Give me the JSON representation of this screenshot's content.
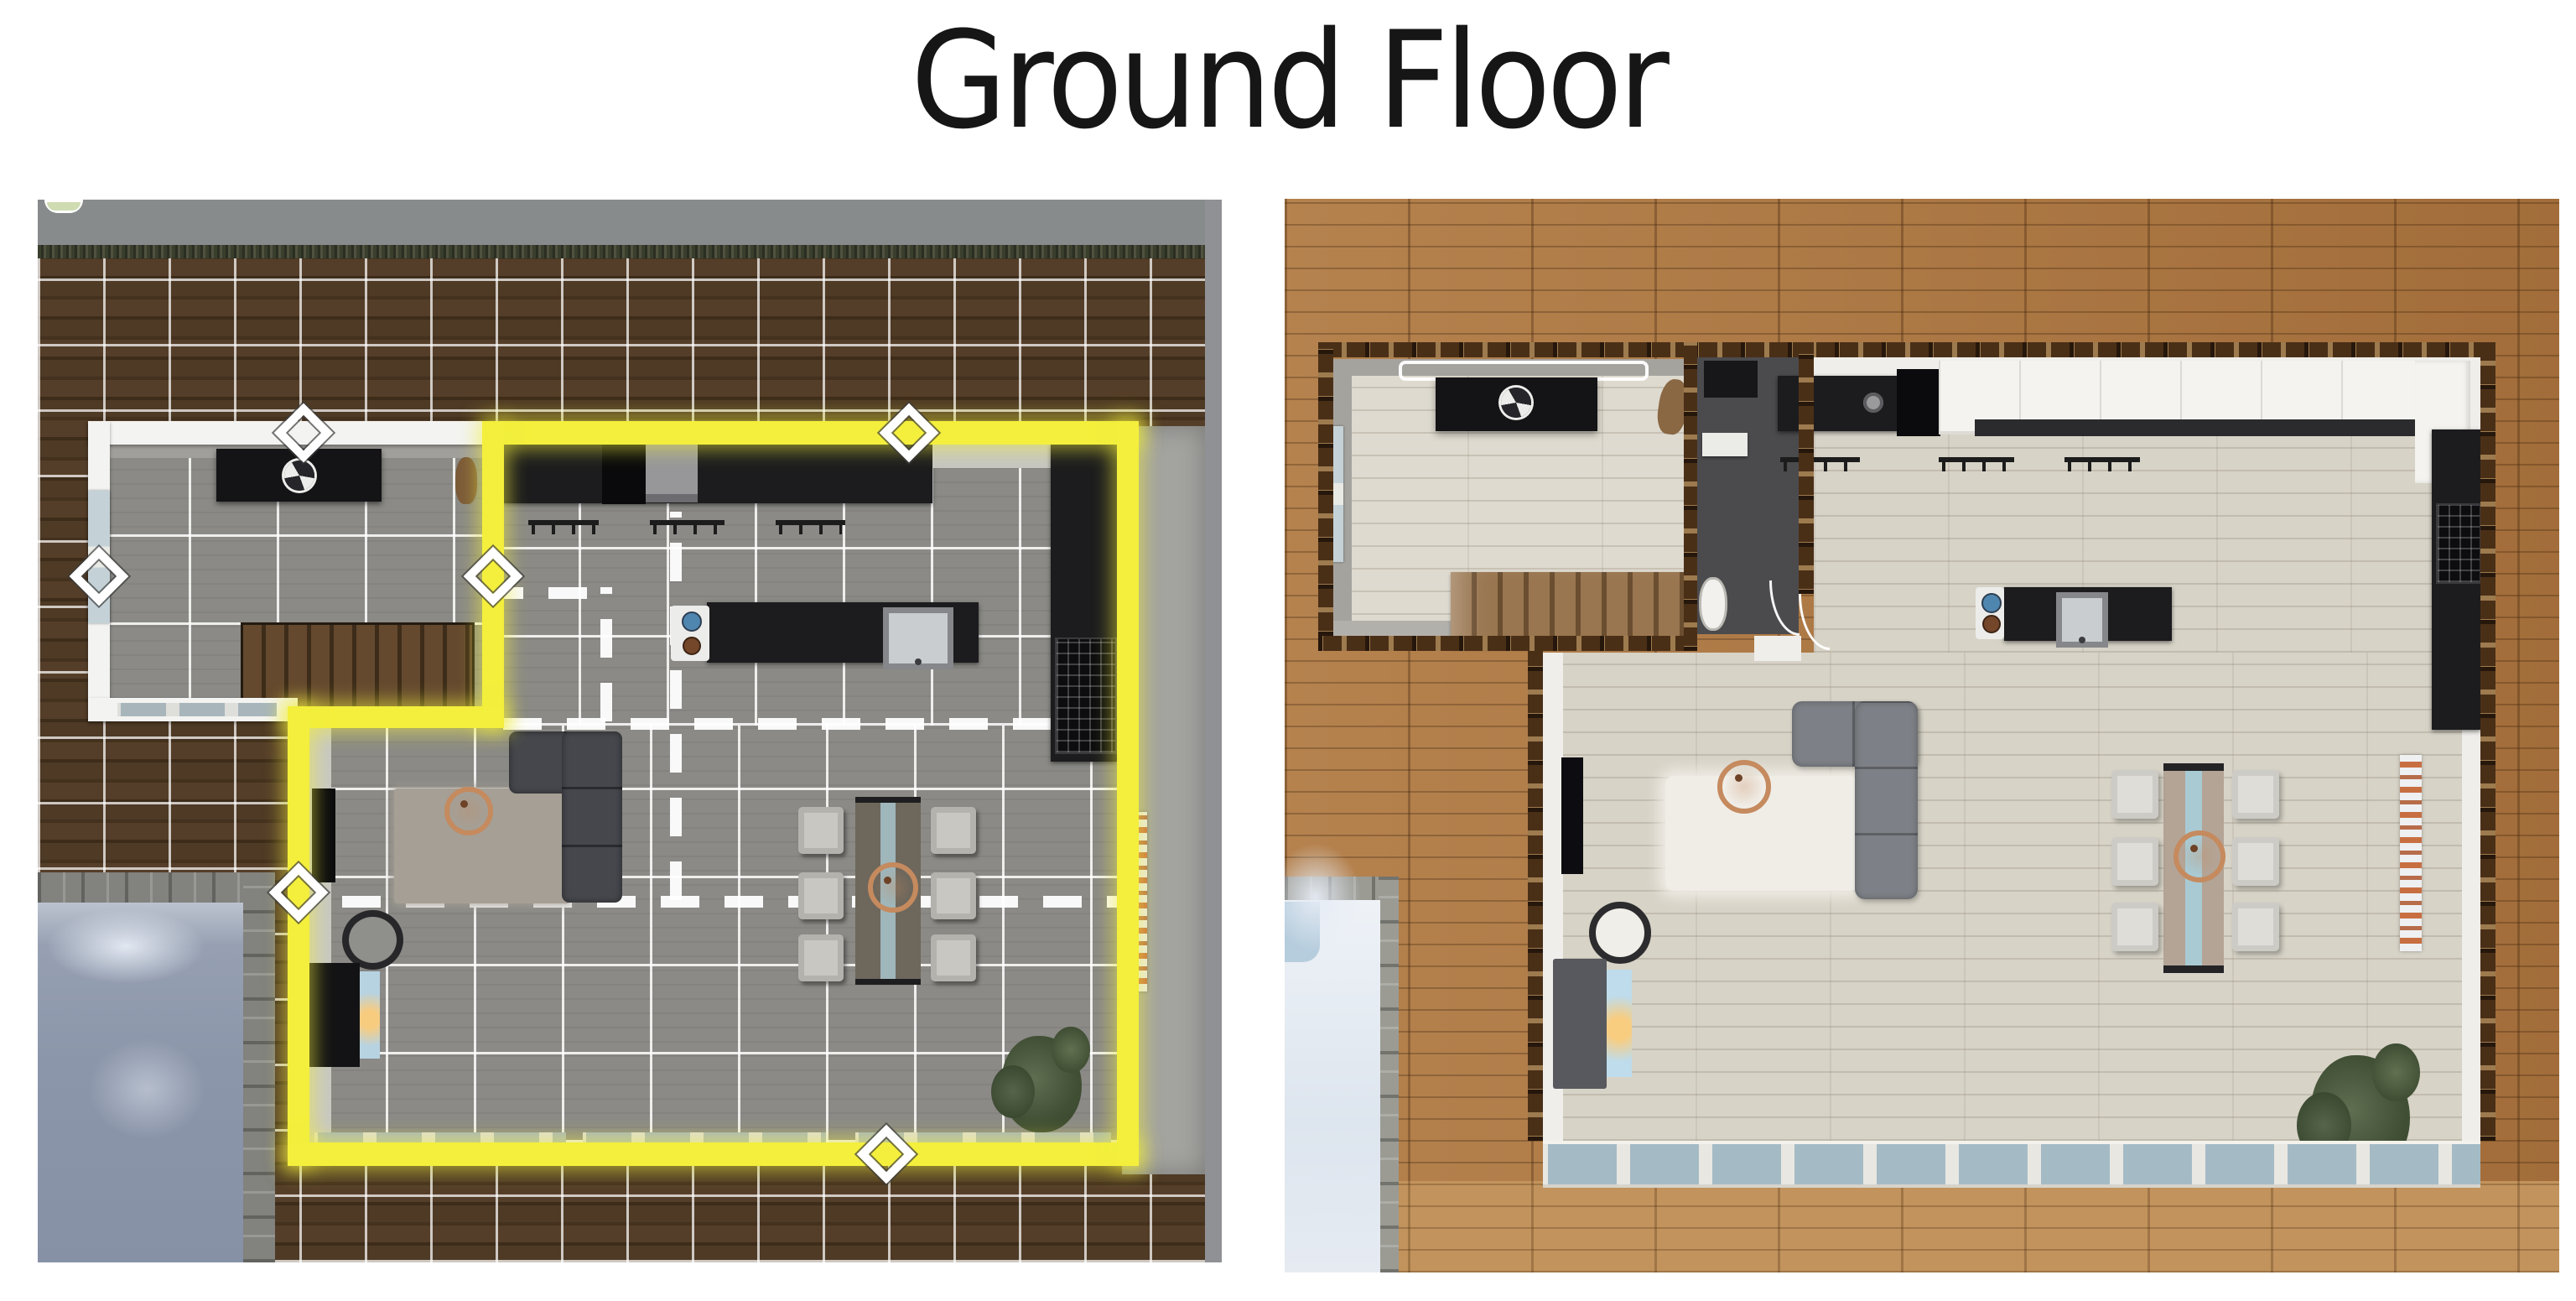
{
  "title": {
    "text": "Ground Floor"
  },
  "panels": {
    "left": {
      "name": "build-mode-floor-plan",
      "description": "Top-down Sims build-mode screenshot: dark wood deck with white placement grid, selected open-plan room outlined in glowing yellow, gray tile floors, dashed lines marking hidden room dividers, white diamond wall handles",
      "rooms": [
        "entry room with stairs",
        "kitchen",
        "living area",
        "dining area"
      ],
      "furniture": [
        "black console with fan ornament",
        "staircase",
        "kitchen counters",
        "fridge",
        "range hood",
        "stove",
        "island sink",
        "wall rails",
        "sectional sofa",
        "area rug",
        "copper decor ball",
        "wall tv",
        "floor pouf",
        "fireplace",
        "dining table",
        "six dining chairs",
        "copper chandelier",
        "orange wall art",
        "potted plant",
        "pet cat"
      ],
      "outdoor": [
        "wood deck with grid",
        "lawn strip",
        "concrete path",
        "swimming pool with stone coping"
      ],
      "ui": [
        "room resize diamond handles",
        "dashed room-divider lines",
        "yellow room selection outline"
      ]
    },
    "right": {
      "name": "furnished-floor-plan",
      "description": "Top-down furnished render of the same ground floor with cut-away timber-framed walls, light plank flooring, bright wood deck and snow-covered pool",
      "rooms": [
        "entry room with stairs",
        "bathroom",
        "kitchen",
        "living area",
        "dining area"
      ],
      "furniture": [
        "black console with fan ornament",
        "ceiling light",
        "staircase",
        "washer",
        "bathroom sink shelf",
        "toilet",
        "kitchen counters",
        "fridge",
        "white upper cabinets",
        "stove",
        "island sink",
        "wall rails",
        "gray sectional sofa",
        "white shag rug",
        "copper decor ball",
        "wall tv",
        "floor pouf",
        "fireplace",
        "live-edge dining table",
        "six white dining chairs",
        "copper chandelier",
        "orange figure wall art",
        "potted plant",
        "pet cat"
      ],
      "outdoor": [
        "golden wood deck",
        "snow-covered pool with stone coping",
        "window row along south wall"
      ]
    }
  },
  "colors": {
    "page_background": "#ffffff",
    "title_text": "#161616",
    "selection_yellow": "#f3ef3c",
    "left_deck": "#46321f",
    "left_tile_floor": "#8b8a86",
    "left_pool_water": "#8c96aa",
    "right_deck": "#ad7943",
    "right_floor": "#d7d3c7",
    "wall_frame_brown": "#4a2f17",
    "counter_black": "#1c1c1e",
    "sofa_left": "#45474c",
    "sofa_right": "#7d8086",
    "copper_accent": "#c58a5e",
    "window_glass": "#a4bbc6",
    "snow_pool": "#e9edf3"
  },
  "icons": {
    "room-handle-icon": "white rotated-square diamond",
    "ceiling-fan-icon": "segmented circle on console",
    "fireplace-flame-icon": "warm glow in blue screen",
    "sink-faucet-icon": "small dark dot"
  }
}
